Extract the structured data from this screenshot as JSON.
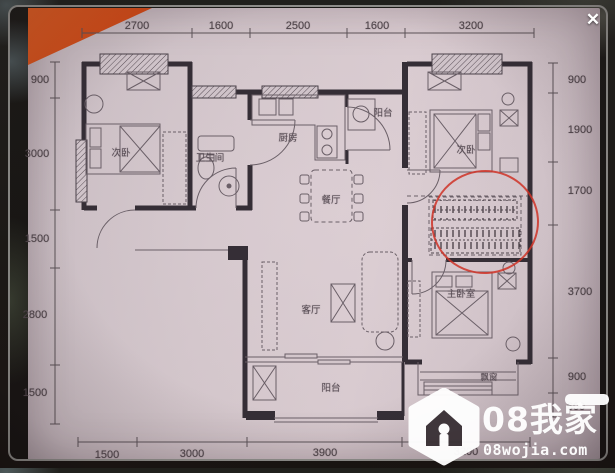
{
  "viewer": {
    "close_label": "✕"
  },
  "plan": {
    "rooms": {
      "bedroom_left": "次卧",
      "bathroom": "卫生间",
      "kitchen": "厨房",
      "balcony_service": "阳台",
      "dining": "餐厅",
      "bedroom_right": "次卧",
      "master_bedroom": "主卧室",
      "living": "客厅",
      "bay_window": "飘窗",
      "balcony_main": "阳台"
    },
    "dims": {
      "top": [
        "2700",
        "1600",
        "2500",
        "1600",
        "3200"
      ],
      "left": [
        "900",
        "3000",
        "1500",
        "2800",
        "1500"
      ],
      "right": [
        "900",
        "1900",
        "1700",
        "3700",
        "900",
        "600"
      ],
      "bottom": [
        "1500",
        "3000",
        "3900",
        "3200"
      ]
    },
    "annotation_color": "#cf3227"
  },
  "watermark": {
    "logo": "home-icon",
    "brand": "08我家",
    "site": "08wojia.com"
  }
}
